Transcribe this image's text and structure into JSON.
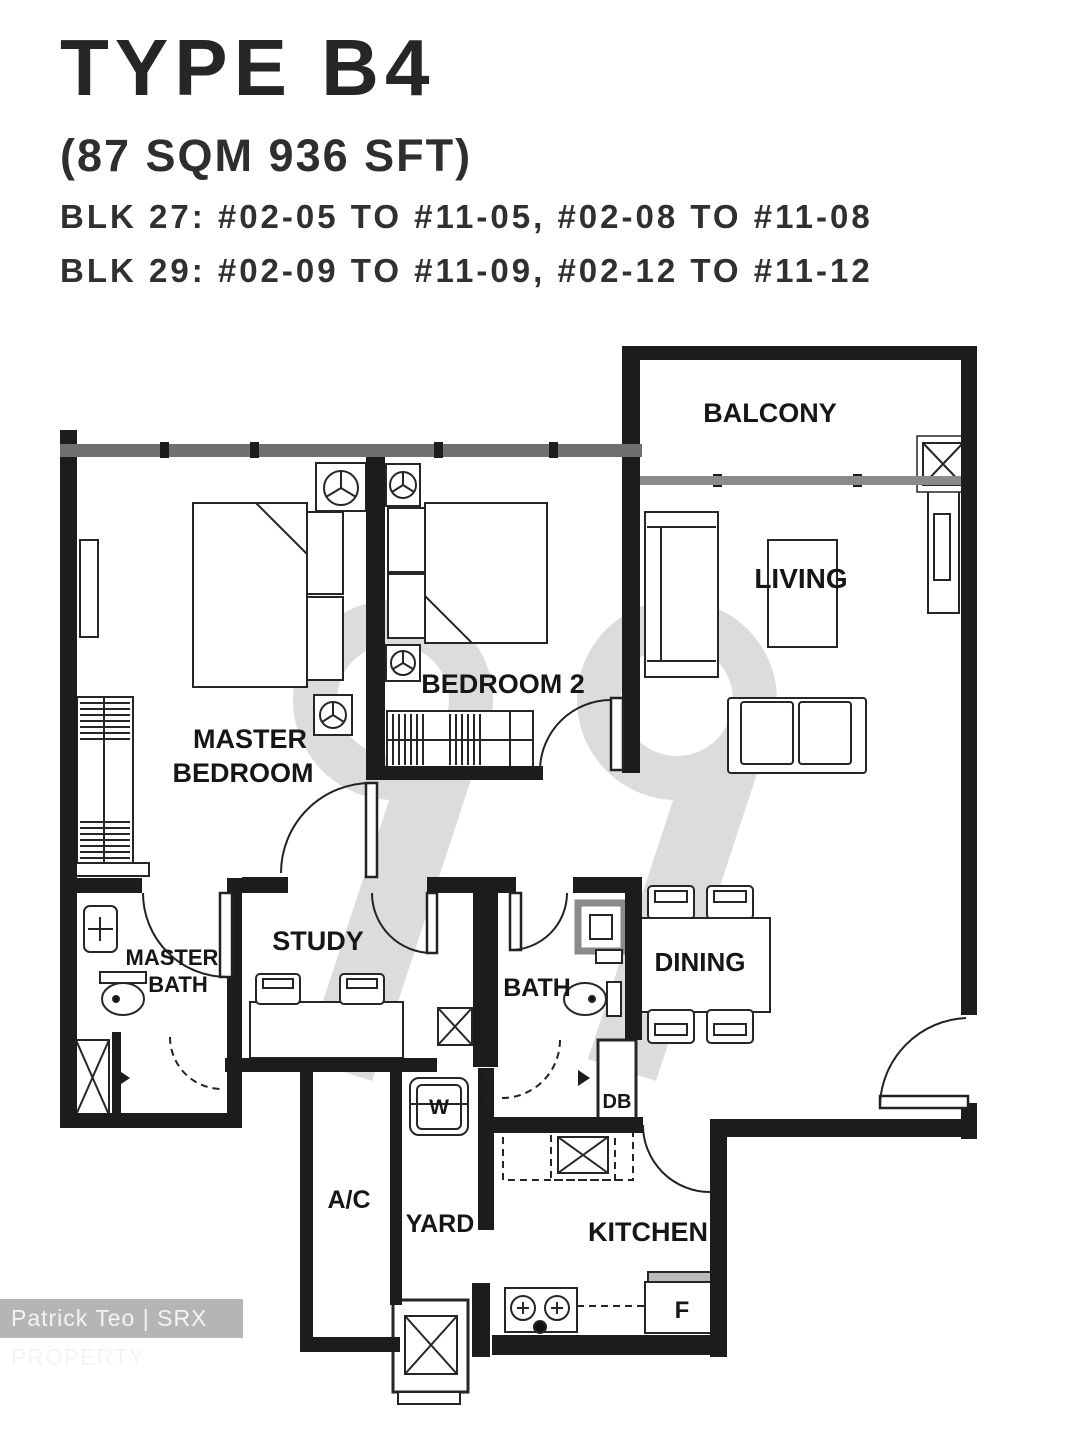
{
  "header": {
    "unit_type": "TYPE B4",
    "area": "(87 SQM  936 SFT)",
    "blocks": [
      "BLK 27: #02-05 TO #11-05, #02-08 TO #11-08",
      "BLK 29: #02-09 TO #11-09, #02-12 TO #11-12"
    ]
  },
  "rooms": {
    "balcony": "BALCONY",
    "living": "LIVING",
    "master_bedroom": [
      "MASTER",
      "BEDROOM"
    ],
    "bedroom2": "BEDROOM 2",
    "study": "STUDY",
    "master_bath": [
      "MASTER",
      "BATH"
    ],
    "bath": "BATH",
    "dining": "DINING",
    "kitchen": "KITCHEN",
    "yard": "YARD",
    "ac_ledge": "A/C"
  },
  "fixtures": {
    "washer": "W",
    "fridge": "F",
    "distribution_board": "DB"
  },
  "watermarks": {
    "logo_digits": "99",
    "credit": "Patrick Teo | SRX PROPERTY"
  },
  "colors": {
    "wall": "#1c1c1c",
    "window_wall": "#707070",
    "logo_gray": "#dcdcdc",
    "credit_bg": "#b5b5b5",
    "credit_text": "#f4f4f4"
  }
}
